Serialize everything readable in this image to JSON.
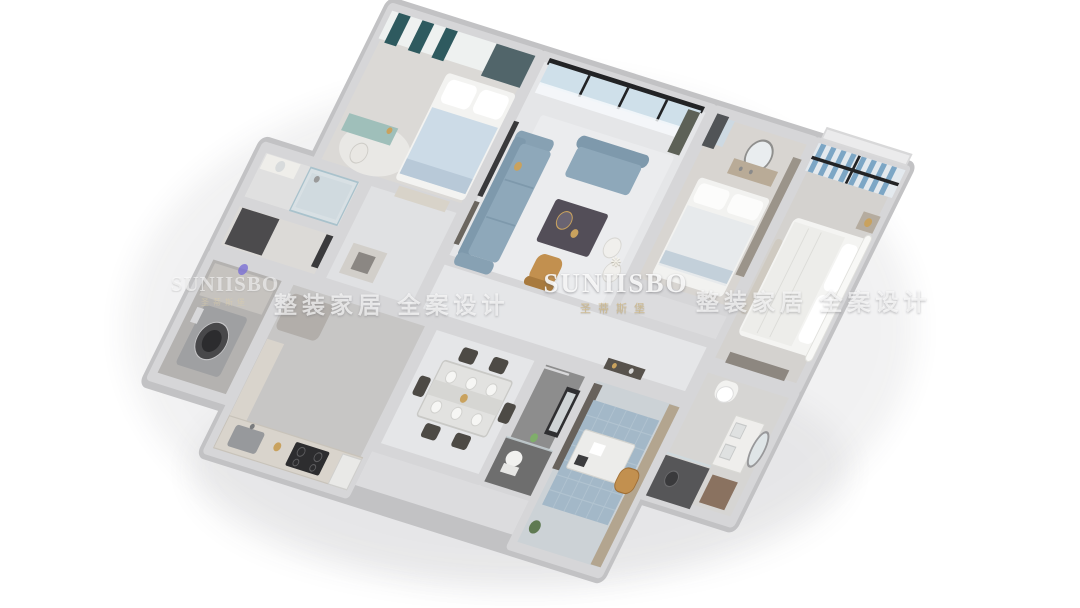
{
  "watermarks": {
    "center_icon_glyph": "❋",
    "center_brand": "SUNIISBO",
    "center_brand_cn": "圣蒂斯堡",
    "left_brand": "SUNIISBO",
    "left_brand_cn": "圣蒂斯堡",
    "slogan_left": "整装家居 全案设计",
    "slogan_right": "整装家居 全案设计"
  },
  "palette": {
    "background": "#ffffff",
    "wall_face": "#d6d6d8",
    "wall_edge": "#c2c2c4",
    "wall_inner": "#dcdcde",
    "floor_marble": "#e5e6e8",
    "floor_light": "#dbd9d6",
    "floor_concrete": "#c7c6c5",
    "floor_dark": "#8d8d8d",
    "floor_laundry": "#b4b2b0",
    "tile_blue": "#a3b8c8",
    "sofa_blue": "#8ea8ba",
    "bed_blue": "#ccdbe7",
    "curtain_teal": "#2e5a5f",
    "curtain_blue": "#7ca6c5",
    "glass_blue": "#cfe0ea",
    "frame_dark": "#222325",
    "table_dark": "#534e58",
    "leather_tan": "#c2904f",
    "wood_light": "#d9d4cc",
    "wood_mid": "#b3a58f",
    "white_soft": "#f3f3f1",
    "gold": "#c9a25e",
    "watermark_gold": "rgba(205,183,138,0.85)"
  },
  "scene": {
    "type": "isometric-3d-floorplan-render",
    "style": "modern apartment, gray walls, blue-gray upholstery",
    "rooms": [
      "bedroom-2",
      "ensuite-bathroom",
      "walkthrough-closet",
      "living-room",
      "bedroom-3",
      "master-bedroom",
      "hallway",
      "laundry-room",
      "kitchen",
      "dining-room",
      "guest-bathroom",
      "study",
      "master-bathroom"
    ]
  }
}
